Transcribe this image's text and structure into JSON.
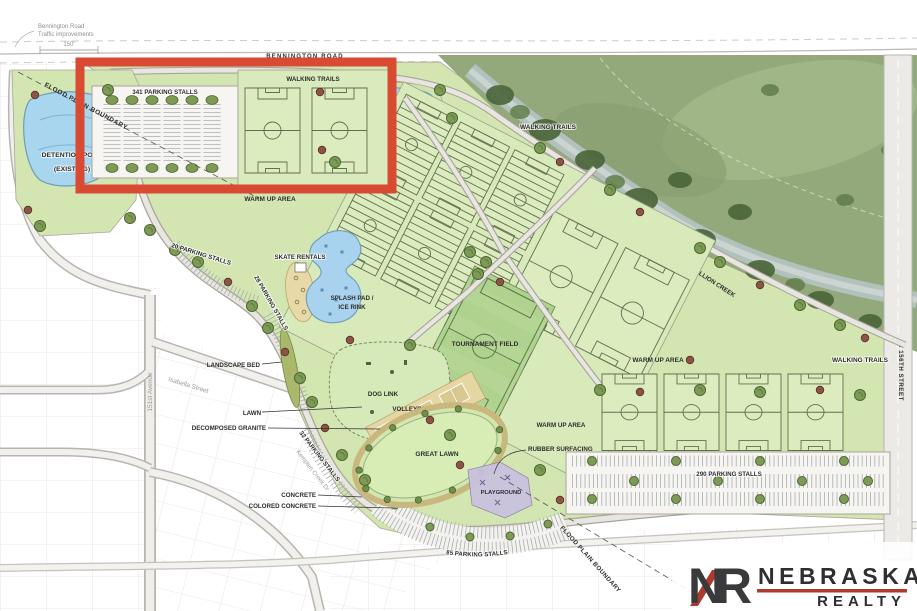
{
  "labels": {
    "bennington_note_line1": "Bennington Road",
    "bennington_note_line2": "Traffic improvements",
    "dim_150": "150'",
    "bennington_road": "BENNINGTON ROAD",
    "flood_plain_boundary": "FLOOD PLAIN BOUNDARY",
    "detention_pond_existing_line1": "DETENTION POND",
    "detention_pond_existing_line2": "(EXISTING)",
    "parking_341": "341 PARKING STALLS",
    "walking_trails": "WALKING TRAILS",
    "detention_pond": "DETENTION POND",
    "warm_up_area": "WARM UP AREA",
    "parking_20": "20 PARKING STALLS",
    "skate_rentals": "SKATE RENTALS",
    "parking_28": "28 PARKING STALLS",
    "splash_pad_line1": "SPLASH PAD /",
    "splash_pad_line2": "ICE RINK",
    "landscape_bed": "LANDSCAPE BED",
    "tournament_field": "TOURNAMENT FIELD",
    "dog_link": "DOG LINK",
    "volleyball": "VOLLEYBALL",
    "lawn": "LAWN",
    "decomposed_granite": "DECOMPOSED GRANITE",
    "great_lawn": "GREAT LAWN",
    "rubber_surfacing": "RUBBER SURFACING",
    "parking_32": "32 PARKING STALLS",
    "concrete": "CONCRETE",
    "colored_concrete": "COLORED CONCRETE",
    "playground": "PLAYGROUND",
    "parking_85": "85 PARKING STALLS",
    "parking_290": "290 PARKING STALLS",
    "big_papillion_creek": "BIG PAPILLION CREEK",
    "n_156th_street": "N 156TH STREET"
  },
  "streets": {
    "avenue_151st": "151st Avenue",
    "isabella": "Isabella Street",
    "kempten": "Kempten Creek Dr"
  },
  "logo": {
    "monogram_n": "N",
    "monogram_r": "R",
    "name": "NEBRASKA",
    "subtitle": "REALTY"
  },
  "colors": {
    "highlight_red": "#d94a33",
    "pond_blue": "#a8d6ef",
    "park_green": "#d3e5b0",
    "field_green": "#dcecbe",
    "tournament_green": "#b5d595",
    "creek_photo_green": "#93a97c",
    "logo_dark": "#3a3a3c",
    "logo_red": "#ae3a2f"
  }
}
